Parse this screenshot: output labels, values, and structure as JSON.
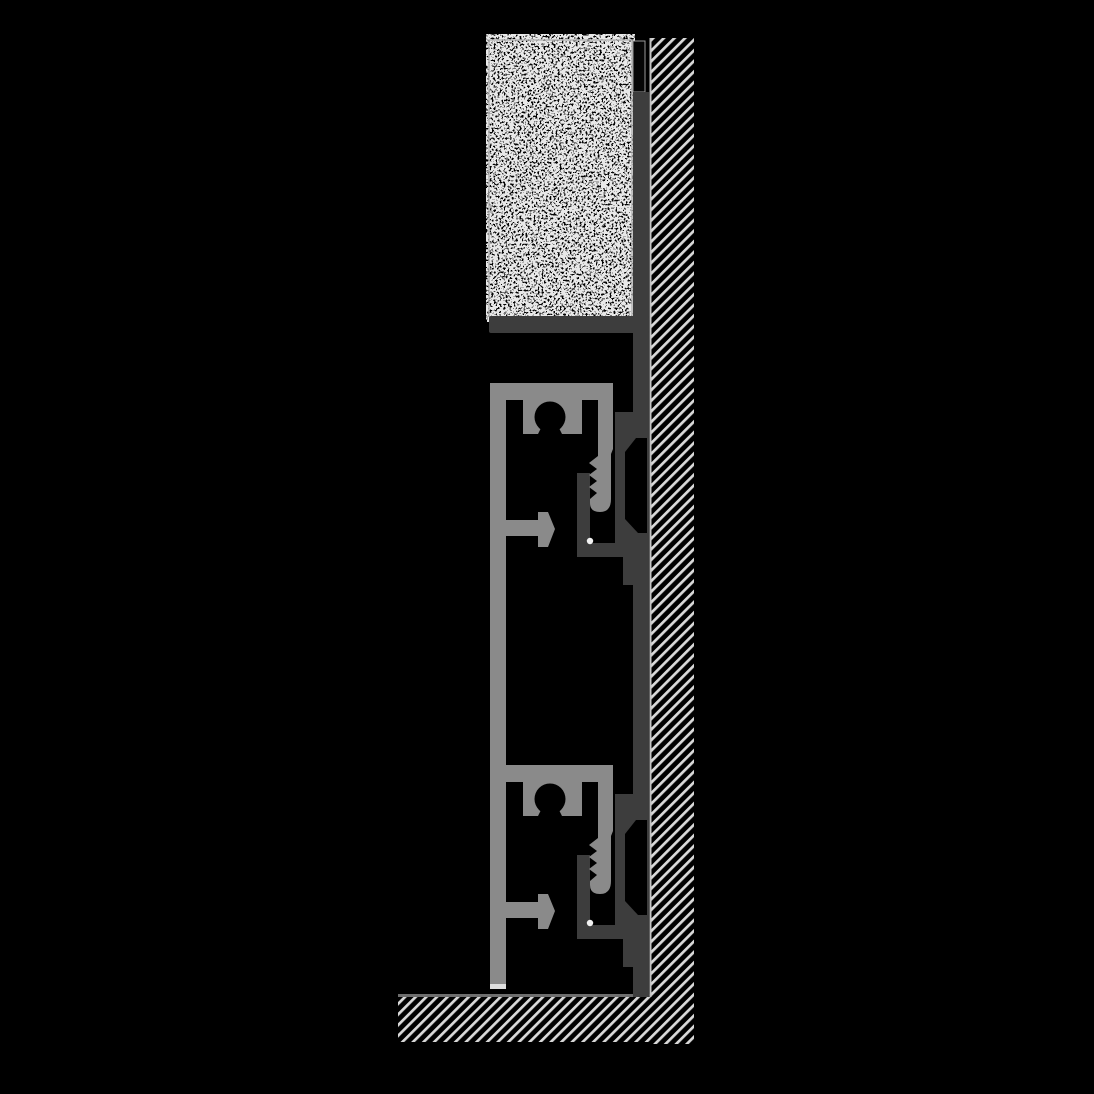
{
  "diagram": {
    "kind": "technical-cross-section",
    "elements": [
      "wall",
      "floor",
      "tile-covering",
      "wall-carrier-profile",
      "skirting-front-profile"
    ]
  },
  "colors": {
    "background": "#000000",
    "profile_light": "#8a8a8a",
    "profile_dark": "#3d3d3d",
    "hatch_line": "#d9d9d9",
    "stipple": "#e8e8e8",
    "tile_border": "#b5b5b5",
    "joint_outline": "#9a9a9a",
    "wall_surface_line": "#c4c4c4",
    "floor_line": "#6e6e6e",
    "rail_tip": "#dedede",
    "drain_dot": "#f2f2f2"
  }
}
